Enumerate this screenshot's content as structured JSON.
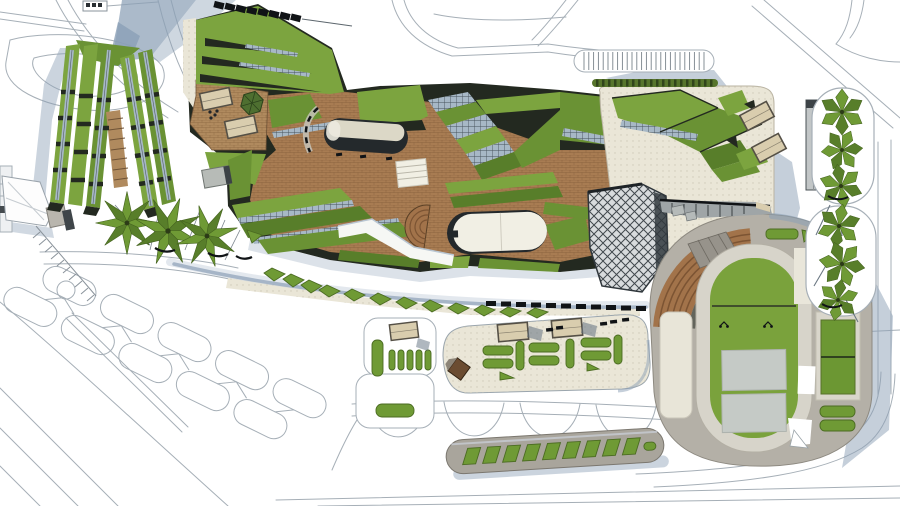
{
  "scene": {
    "description": "Top-down architectural master-plan rendering: stepped linear green-roof towers on the left, a large central complex of angular green roofs with terracotta terraces, white pavilion roofs, a spiral drop-off ramp and amphitheater steps, a diagrid-roof tower, an east entry plaza with parking strip, elevated canopy-tree islands, a south plaza with hedge planters, a pergola platform, and an oval running-track stadium with sports courts and curved grandstand seating, all set in a white line-drawn road network",
    "regions": [
      "road-network",
      "path-lattice",
      "linear-green-roof-towers",
      "roof-terrace-with-canopies",
      "central-green-roof-complex",
      "terracotta-terrace-plaza",
      "white-pavilion-roofs",
      "spiral-dropoff-ramp",
      "amphitheater-steps",
      "diagrid-roof-tower",
      "east-entry-plaza",
      "parking-strip",
      "canopy-tree-islands",
      "stadium-running-track",
      "sports-courts",
      "tennis-court",
      "grandstand-seating",
      "south-plaza-with-hedges",
      "pergola-platform",
      "palm-tree-cluster",
      "shrub-row",
      "covered-walkway-dashes"
    ]
  },
  "palette": {
    "bg": "#ffffff",
    "roadLine": "#a6afb7",
    "roadDark": "#7f8b95",
    "shadow": "#8ba0b6",
    "shadowSoft": "#c7d2de",
    "grass1": "#7ca43f",
    "grass2": "#6a9234",
    "grass3": "#587e2a",
    "grass4": "#8db14d",
    "hedge": "#6f9a35",
    "hedgeDark": "#4b6b22",
    "treeDark": "#44621f",
    "darkBase": "#232920",
    "mullion": "#46525b",
    "glazing": "#a7b8c6",
    "brick": "#a87c52",
    "deck": "#b08a5e",
    "stepBrown": "#a2734a",
    "stepLine": "#7c5433",
    "paving": "#eae6d7",
    "pavingDot": "#cfc9b6",
    "concrete": "#b4b0a7",
    "track": "#d7d4ca",
    "court": "#c5cac6",
    "field": "#7aa23c",
    "sportGreen": "#6c9733",
    "canopy": "#d9cdae",
    "canopyLine": "#555046",
    "offWhite": "#f1efe4",
    "black": "#101316",
    "steel": "#9aa0a4"
  }
}
